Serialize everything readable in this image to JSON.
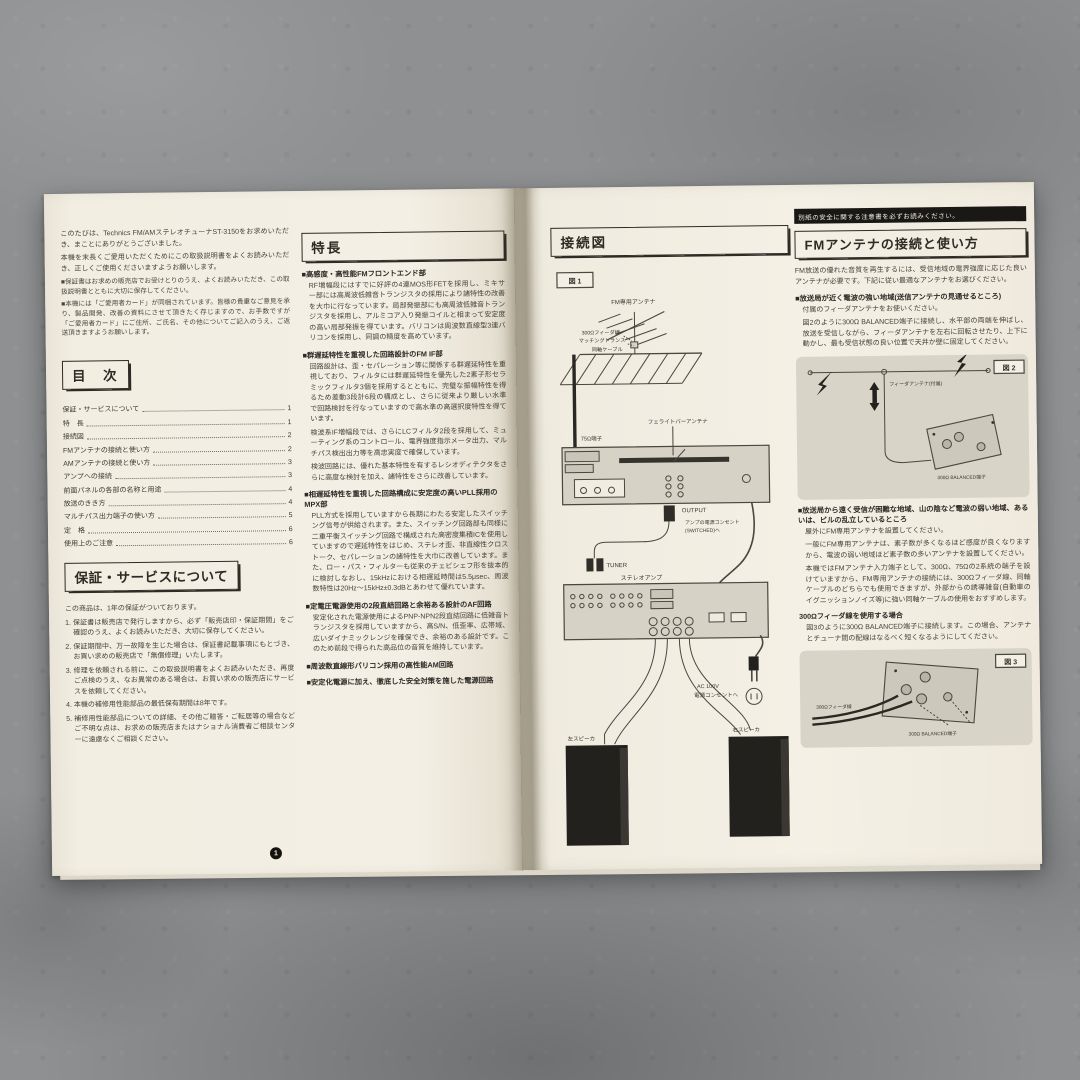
{
  "left_page": {
    "intro_p1": "このたびは、Technics FM/AMステレオチューナST-3150をお求めいただき、まことにありがとうございました。",
    "intro_p2": "本機を末長くご愛用いただくためにこの取扱説明書をよくお読みいただき、正しくご使用くださいますようお願いします。",
    "notes": [
      "■保証書はお求めの販売店でお受けとりのうえ、よくお読みいただき、この取扱説明書とともに大切に保存してください。",
      "■本機には「ご愛用者カード」が同梱されています。皆様の貴重なご意見を承り、製品開発、改善の資料にさせて頂きたく存じますので、お手数ですが「ご愛用者カード」にご住所、ご氏名、その他についてご記入のうえ、ご返送頂きますようお願いします。"
    ],
    "toc": {
      "title": "目　次",
      "items": [
        {
          "label": "保証・サービスについて",
          "page": "1"
        },
        {
          "label": "特　長",
          "page": "1"
        },
        {
          "label": "接続図",
          "page": "2"
        },
        {
          "label": "FMアンテナの接続と使い方",
          "page": "2"
        },
        {
          "label": "AMアンテナの接続と使い方",
          "page": "3"
        },
        {
          "label": "アンプへの接続",
          "page": "3"
        },
        {
          "label": "前面パネルの各部の名称と用途",
          "page": "4"
        },
        {
          "label": "放送のきき方",
          "page": "4"
        },
        {
          "label": "マルチパス出力端子の使い方",
          "page": "5"
        },
        {
          "label": "定　格",
          "page": "6"
        },
        {
          "label": "使用上のご注意",
          "page": "6"
        }
      ]
    },
    "warranty": {
      "title": "保証・サービスについて",
      "lead": "この商品は、1年の保証がついております。",
      "items": [
        "1. 保証書は販売店で発行しますから、必ず「販売店印・保証期間」をご確認のうえ、よくお読みいただき、大切に保存してください。",
        "2. 保証期間中、万一故障を生じた場合は、保証書記載事項にもとづき、お買い求めの販売店で「無償修理」いたします。",
        "3. 修理を依頼される前に、この取扱説明書をよくお読みいただき、再度ご点検のうえ、なお異常のある場合は、お買い求めの販売店にサービスを依頼してください。",
        "4. 本機の補修用性能部品の最低保有期間は8年です。",
        "5. 補修用性能部品についての詳細、その他ご贈答・ご転居等の場合などご不明な点は、お求めの販売店またはナショナル消費者ご相談センターに遠慮なくご相談ください。"
      ]
    },
    "page_number": "1"
  },
  "features": {
    "title": "特長",
    "sections": [
      {
        "heading": "■高感度・高性能FMフロントエンド部",
        "paras": [
          "RF増幅段にはすでに好評の4連MOS形FETを採用し、ミキサー部には高周波低雑音トランジスタの採用により諸特性の改善を大巾に行なっています。局部発振部にも高周波低雑音トランジスタを採用し、アルミコア入り発振コイルと相まって安定度の高い局部発振を得ています。バリコンは周波数直線型3連バリコンを採用し、同調の精度を高めています。"
        ]
      },
      {
        "heading": "■群遅延特性を重視した回路設計のFM IF部",
        "paras": [
          "回路設計は、歪・セパレーション等に関係する群遅延特性を重視しており、フィルタには群遅延特性を優先した2素子形セラミックフィルタ3個を採用するとともに、完璧な振幅特性を得るため差動3段計6段の構成とし、さらに従来より厳しい水準で回路検討を行なっていますので高水準の高選択度特性を得ています。",
          "検波系IF増幅段では、さらにLCフィルタ2段を採用して、ミューティング系のコントロール、電界強度指示メータ出力、マルチパス検出出力等を高忠実度で確保しています。",
          "検波回路には、優れた基本特性を有するレシオディテクタをさらに高度な検討を加え、諸特性をさらに改善しています。"
        ]
      },
      {
        "heading": "■相遅延特性を重視した回路構成に安定度の高いPLL採用のMPX部",
        "paras": [
          "PLL方式を採用していますから長期にわたる安定したスイッチング信号が供給されます。また、スイッチング回路部も同様に二重平衡スイッチング回路で構成された高密度集積ICを使用していますので遅延特性をはじめ、ステレオ歪、非直線性クロストーク、セパレーションの諸特性を大巾に改善しています。また、ロー・パス・フィルターも従来のチェビシェフ形を抜本的に検討しなおし、15kHzにおける相遅延時間は5.5μsec、周波数特性は20Hz〜15kHz±0.3dBとあわせて優れています。"
        ]
      },
      {
        "heading": "■定電圧電源使用の2段直結回路と余裕ある設計のAF回路",
        "paras": [
          "安定化された電源使用によるPNP-NPN2段直結回路に低雑音トランジスタを採用していますから、高S/N、低歪率、広帯域、広いダイナミックレンジを確保でき、余裕のある設計です。このため前段で得られた高品位の音質を維持しています。"
        ]
      },
      {
        "heading": "■周波数直線形バリコン採用の高性能AM回路",
        "paras": []
      },
      {
        "heading": "■安定化電源に加え、徹底した安全対策を施した電源回路",
        "paras": []
      }
    ]
  },
  "right_page": {
    "notice": "別紙の安全に関する注意書を必ずお読みください。",
    "connection": {
      "title": "接続図",
      "fig_label": "図 1",
      "labels": {
        "fm_antenna": "FM専用アンテナ",
        "feeder": "300Ωフィーダ線",
        "matching": "マッチングトランス",
        "coax": "同軸ケーブル",
        "terminal75": "75Ω端子",
        "ferrite": "フェライトバーアンテナ",
        "output": "OUTPUT",
        "switched1": "アンプの電源コンセント",
        "switched2": "(SWITCHED)へ",
        "tuner": "TUNER",
        "amp": "ステレオアンプ",
        "ac1": "AC 100V",
        "ac2": "電源コンセントへ",
        "left_speaker": "左スピーカ",
        "right_speaker": "右スピーカ"
      }
    },
    "fm_guide": {
      "title": "FMアンテナの接続と使い方",
      "lead": "FM放送の優れた音質を再生するには、受信地域の電界強度に応じた良いアンテナが必要です。下記に従い最適なアンテナをお選びください。",
      "s1_heading": "■放送局が近く電波の強い地域(送信アンテナの見通せるところ)",
      "s1_p1": "付属のフィーダアンテナをお使いください。",
      "s1_p2": "図2のように300Ω BALANCED端子に接続し、水平部の両端を伸ばし、放送を受信しながら、フィーダアンテナを左右に回転させたり、上下に動かし、最も受信状態の良い位置で天井か壁に固定してください。",
      "fig2_label": "図 2",
      "fig2_antenna": "フィーダアンテナ(付属)",
      "fig2_terminal": "300Ω BALANCED端子",
      "s2_heading": "■放送局から遠く受信が困難な地域、山の陰など電波の弱い地域、あるいは、ビルの乱立しているところ",
      "s2_p1": "屋外にFM専用アンテナを設置してください。",
      "s2_p2": "一般にFM専用アンテナは、素子数が多くなるほど感度が良くなりますから、電波の弱い地域ほど素子数の多いアンテナを設置してください。",
      "s2_p3": "本機ではFMアンテナ入力端子として、300Ω、75Ωの2系統の端子を設けていますから、FM専用アンテナの接続には、300Ωフィーダ線、同軸ケーブルのどちらでも使用できますが、外部からの誘導雑音(自動車のイグニッションノイズ等)に強い同軸ケーブルの使用をおすすめします。",
      "s3_heading": "300Ωフィーダ線を使用する場合",
      "s3_p1": "図3のように300Ω BALANCED端子に接続します。この場合、アンテナとチューナ間の配線はなるべく短くなるようにしてください。",
      "fig3_label": "図 3",
      "fig3_feeder": "300Ωフィーダ線",
      "fig3_terminal": "300Ω BALANCED端子"
    },
    "page_number": "2"
  }
}
